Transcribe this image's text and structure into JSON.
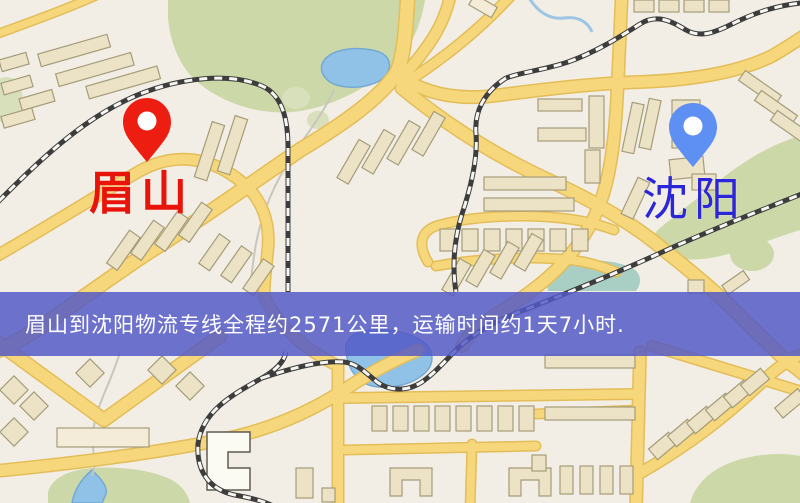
{
  "map": {
    "markers": {
      "origin": {
        "label": "眉山",
        "label_color": "#e8140a",
        "pin_icon": "red-map-pin-icon",
        "pin_color": "#ee1d12"
      },
      "destination": {
        "label": "沈阳",
        "label_color": "#2b26d8",
        "pin_icon": "blue-map-pin-icon",
        "pin_color": "#5e8ff2"
      }
    },
    "banner": {
      "text": "眉山到沈阳物流专线全程约2571公里，运输时间约1天7小时.",
      "background_color": "#555cc4",
      "text_color": "#ffffff",
      "route": {
        "origin": "眉山",
        "destination": "沈阳",
        "distance_km": "2571",
        "duration": "1天7小时"
      }
    },
    "palette": {
      "background": "#f2eee5",
      "road": "#f7d77c",
      "road_casing": "#e3bd58",
      "building_fill": "#ece2c6",
      "building_stroke": "#a59c79",
      "park_green": "#ccd8a8",
      "water_blue": "#90c2e8",
      "railway_dark": "#3d3d3d"
    }
  }
}
